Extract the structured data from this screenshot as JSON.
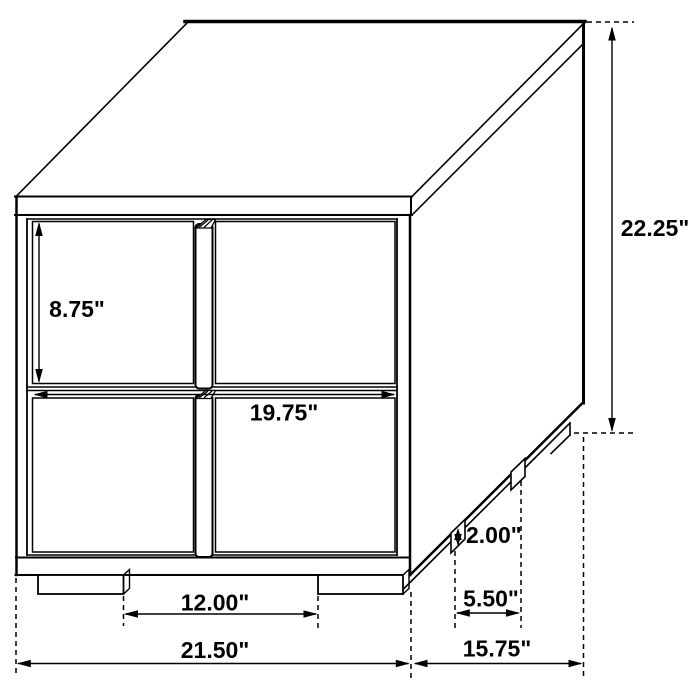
{
  "diagram": {
    "type": "furniture-dimension-drawing",
    "subject": "two-drawer nightstand isometric line drawing",
    "line_color": "#000000",
    "background_color": "#ffffff"
  },
  "dimensions": {
    "overall_height": {
      "label": "22.25\""
    },
    "drawer_front_height": {
      "label": "8.75\""
    },
    "drawer_front_width": {
      "label": "19.75\""
    },
    "front_feet_spacing": {
      "label": "12.00\""
    },
    "overall_width": {
      "label": "21.50\""
    },
    "overall_depth": {
      "label": "15.75\""
    },
    "side_feet_spacing": {
      "label": "5.50\""
    },
    "foot_height": {
      "label": "2.00\""
    }
  }
}
